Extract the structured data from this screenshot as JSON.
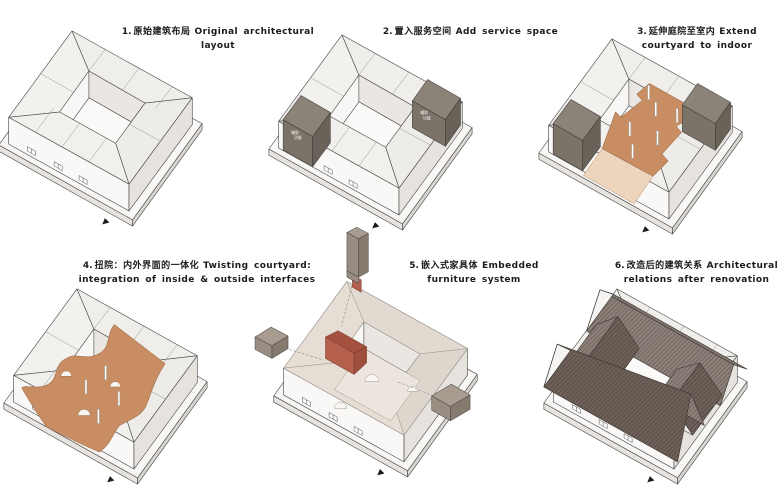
{
  "page": {
    "background": "#ffffff"
  },
  "colors": {
    "terracotta": "#c98d64",
    "terracotta_light": "#ecd4bd",
    "red_furniture": "#b5604d",
    "red_furniture_side": "#9e4f3e",
    "red_furniture_roof": "#a4523f",
    "dark_box": "#8b8278",
    "dark_box_front": "#7b7268",
    "dark_box_side": "#6a6258",
    "roof_gray": "#8d8079",
    "roof_dark": "#6f6159",
    "float_box_top": "#a79c8f",
    "float_box_front": "#988d80",
    "float_box_side": "#857a6e"
  },
  "diagrams": [
    {
      "num": "1.",
      "zh": "原始建筑布局",
      "en": "Original architectural layout"
    },
    {
      "num": "2.",
      "zh": "置入服务空间",
      "en": "Add service space",
      "service_box": {
        "line1": "辅助",
        "line2": "功能"
      }
    },
    {
      "num": "3.",
      "zh": "延伸庭院至室内",
      "en": "Extend courtyard to indoor"
    },
    {
      "num": "4.",
      "zh": "扭院：内外界面的一体化",
      "en": "Twisting courtyard: integration of inside & outside interfaces"
    },
    {
      "num": "5.",
      "zh": "嵌入式家具体",
      "en": "Embedded furniture system"
    },
    {
      "num": "6.",
      "zh": "改造后的建筑关系",
      "en": "Architectural relations after renovation"
    }
  ]
}
